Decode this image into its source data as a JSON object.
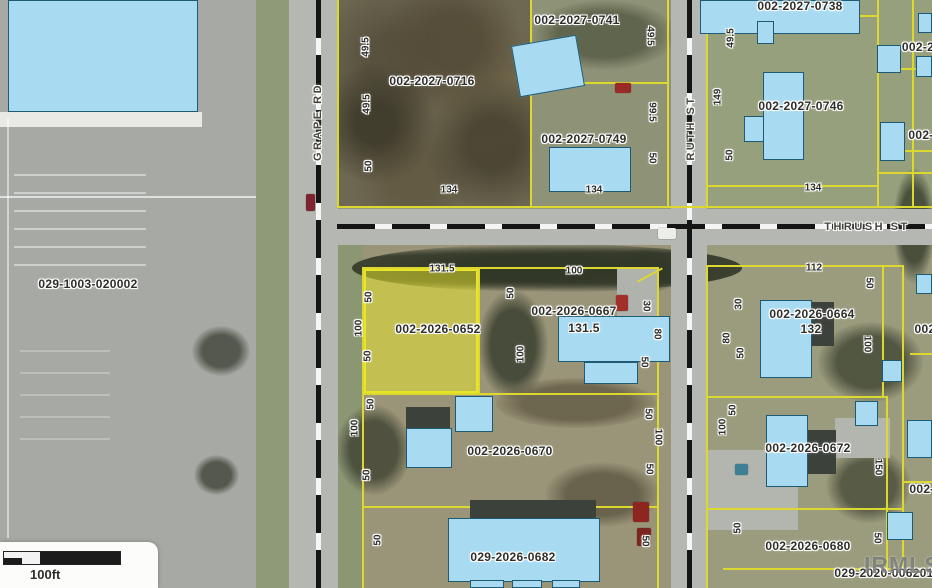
{
  "map": {
    "watermark": "IRMLS",
    "scale_bar": {
      "label": "100ft"
    },
    "highlight": {
      "parcel_id": "002-2026-0652",
      "x": 364,
      "y": 269,
      "w": 114,
      "h": 124
    },
    "colors": {
      "parcel_line": "#dcd82f",
      "highlight_fill": "rgba(236,233,42,0.5)",
      "highlight_edge": "#e8e428",
      "building_fill": "#a8dbf2",
      "building_edge": "#1d5a74",
      "label_text": "#2e2e2a",
      "street_text": "#45453c"
    },
    "streets": [
      {
        "name": "GRAPE RD",
        "x": 318,
        "y": 122,
        "rot": -90
      },
      {
        "name": "THRUSH ST",
        "x": 867,
        "y": 227,
        "rot": 0
      },
      {
        "name": "RUTH ST",
        "x": 691,
        "y": 128,
        "rot": -90
      }
    ],
    "parcel_labels": [
      {
        "text": "002-2027-0741",
        "x": 577,
        "y": 20
      },
      {
        "text": "002-2027-0716",
        "x": 432,
        "y": 81
      },
      {
        "text": "002-2027-0749",
        "x": 584,
        "y": 139
      },
      {
        "text": "002-2027-0738",
        "x": 800,
        "y": 6
      },
      {
        "text": "002-2027-0746",
        "x": 801,
        "y": 106
      },
      {
        "text": "029-1003-020002",
        "x": 88,
        "y": 284
      },
      {
        "text": "002-2026-0652",
        "x": 438,
        "y": 329
      },
      {
        "text": "002-2026-0667",
        "x": 574,
        "y": 311
      },
      {
        "text": "131.5",
        "x": 584,
        "y": 328
      },
      {
        "text": "002-2026-0664",
        "x": 812,
        "y": 314
      },
      {
        "text": "132",
        "x": 811,
        "y": 329
      },
      {
        "text": "002-2026-0670",
        "x": 510,
        "y": 451
      },
      {
        "text": "002-2026-0672",
        "x": 808,
        "y": 448
      },
      {
        "text": "029-2026-0682",
        "x": 513,
        "y": 557
      },
      {
        "text": "002-2026-0680",
        "x": 808,
        "y": 546
      },
      {
        "text": "029-2020-006201",
        "x": 884,
        "y": 573
      },
      {
        "text": "002-2",
        "x": 918,
        "y": 47
      },
      {
        "text": "002-",
        "x": 921,
        "y": 135
      },
      {
        "text": "002",
        "x": 925,
        "y": 329
      },
      {
        "text": "002-",
        "x": 922,
        "y": 489
      }
    ],
    "dimension_labels": [
      {
        "text": "49.5",
        "x": 366,
        "y": 47,
        "rot": -90
      },
      {
        "text": "49.5",
        "x": 367,
        "y": 104,
        "rot": -90
      },
      {
        "text": "50",
        "x": 369,
        "y": 166,
        "rot": -90
      },
      {
        "text": "134",
        "x": 449,
        "y": 190,
        "rot": 0
      },
      {
        "text": "134",
        "x": 594,
        "y": 190,
        "rot": 0
      },
      {
        "text": "49.5",
        "x": 650,
        "y": 36,
        "rot": 90
      },
      {
        "text": "99.5",
        "x": 652,
        "y": 112,
        "rot": 90
      },
      {
        "text": "50",
        "x": 652,
        "y": 158,
        "rot": 90
      },
      {
        "text": "49.5",
        "x": 731,
        "y": 38,
        "rot": -90
      },
      {
        "text": "149",
        "x": 718,
        "y": 97,
        "rot": -90
      },
      {
        "text": "50",
        "x": 730,
        "y": 155,
        "rot": -90
      },
      {
        "text": "134",
        "x": 813,
        "y": 188,
        "rot": 0
      },
      {
        "text": "131.5",
        "x": 442,
        "y": 269,
        "rot": 0
      },
      {
        "text": "100",
        "x": 574,
        "y": 271,
        "rot": 0
      },
      {
        "text": "112",
        "x": 814,
        "y": 268,
        "rot": 0
      },
      {
        "text": "50",
        "x": 369,
        "y": 297,
        "rot": -90
      },
      {
        "text": "100",
        "x": 359,
        "y": 328,
        "rot": -90
      },
      {
        "text": "50",
        "x": 368,
        "y": 356,
        "rot": -90
      },
      {
        "text": "50",
        "x": 511,
        "y": 293,
        "rot": -90
      },
      {
        "text": "100",
        "x": 521,
        "y": 354,
        "rot": -90
      },
      {
        "text": "30",
        "x": 646,
        "y": 306,
        "rot": 90
      },
      {
        "text": "80",
        "x": 657,
        "y": 334,
        "rot": 90
      },
      {
        "text": "50",
        "x": 644,
        "y": 362,
        "rot": 90
      },
      {
        "text": "30",
        "x": 739,
        "y": 304,
        "rot": -90
      },
      {
        "text": "80",
        "x": 727,
        "y": 338,
        "rot": -90
      },
      {
        "text": "50",
        "x": 741,
        "y": 353,
        "rot": -90
      },
      {
        "text": "50",
        "x": 869,
        "y": 283,
        "rot": 90
      },
      {
        "text": "100",
        "x": 867,
        "y": 344,
        "rot": 90
      },
      {
        "text": "50",
        "x": 371,
        "y": 404,
        "rot": -90
      },
      {
        "text": "100",
        "x": 355,
        "y": 428,
        "rot": -90
      },
      {
        "text": "50",
        "x": 367,
        "y": 475,
        "rot": -90
      },
      {
        "text": "50",
        "x": 378,
        "y": 540,
        "rot": -90
      },
      {
        "text": "50",
        "x": 648,
        "y": 414,
        "rot": 90
      },
      {
        "text": "100",
        "x": 658,
        "y": 437,
        "rot": 90
      },
      {
        "text": "50",
        "x": 649,
        "y": 469,
        "rot": 90
      },
      {
        "text": "50",
        "x": 645,
        "y": 541,
        "rot": 90
      },
      {
        "text": "50",
        "x": 733,
        "y": 410,
        "rot": -90
      },
      {
        "text": "100",
        "x": 723,
        "y": 427,
        "rot": -90
      },
      {
        "text": "150",
        "x": 878,
        "y": 467,
        "rot": 90
      },
      {
        "text": "50",
        "x": 877,
        "y": 538,
        "rot": 90
      },
      {
        "text": "50",
        "x": 738,
        "y": 528,
        "rot": -90
      }
    ],
    "parcel_lines": [
      [
        337,
        0,
        2,
        208
      ],
      [
        530,
        0,
        2,
        208
      ],
      [
        667,
        0,
        2,
        208
      ],
      [
        706,
        0,
        2,
        208
      ],
      [
        877,
        0,
        2,
        208
      ],
      [
        912,
        0,
        2,
        208
      ],
      [
        531,
        82,
        138,
        2
      ],
      [
        706,
        15,
        171,
        2
      ],
      [
        877,
        68,
        55,
        2
      ],
      [
        877,
        172,
        55,
        2
      ],
      [
        706,
        185,
        171,
        2
      ],
      [
        337,
        206,
        595,
        2
      ],
      [
        362,
        267,
        2,
        321
      ],
      [
        362,
        267,
        296,
        2
      ],
      [
        478,
        268,
        2,
        127
      ],
      [
        657,
        267,
        2,
        321
      ],
      [
        362,
        393,
        296,
        2
      ],
      [
        362,
        506,
        297,
        2
      ],
      [
        636,
        274,
        28,
        2,
        -28
      ],
      [
        706,
        265,
        198,
        2
      ],
      [
        706,
        267,
        2,
        321
      ],
      [
        882,
        267,
        2,
        130
      ],
      [
        886,
        396,
        2,
        174
      ],
      [
        902,
        265,
        2,
        303
      ],
      [
        706,
        396,
        180,
        2
      ],
      [
        706,
        508,
        198,
        2
      ],
      [
        723,
        568,
        209,
        2
      ],
      [
        903,
        481,
        29,
        2
      ],
      [
        910,
        353,
        22,
        2
      ],
      [
        905,
        150,
        27,
        2
      ]
    ],
    "buildings": [
      {
        "x": 8,
        "y": 0,
        "w": 190,
        "h": 112
      },
      {
        "x": 515,
        "y": 40,
        "w": 66,
        "h": 52,
        "r": -10
      },
      {
        "x": 549,
        "y": 147,
        "w": 82,
        "h": 45
      },
      {
        "x": 700,
        "y": 0,
        "w": 160,
        "h": 34
      },
      {
        "x": 757,
        "y": 21,
        "w": 17,
        "h": 23
      },
      {
        "x": 763,
        "y": 72,
        "w": 41,
        "h": 88
      },
      {
        "x": 744,
        "y": 116,
        "w": 20,
        "h": 26
      },
      {
        "x": 877,
        "y": 45,
        "w": 24,
        "h": 28
      },
      {
        "x": 880,
        "y": 122,
        "w": 25,
        "h": 39
      },
      {
        "x": 916,
        "y": 56,
        "w": 16,
        "h": 21
      },
      {
        "x": 918,
        "y": 13,
        "w": 14,
        "h": 20
      },
      {
        "x": 558,
        "y": 316,
        "w": 112,
        "h": 46
      },
      {
        "x": 584,
        "y": 362,
        "w": 54,
        "h": 22
      },
      {
        "x": 760,
        "y": 300,
        "w": 52,
        "h": 78
      },
      {
        "x": 882,
        "y": 360,
        "w": 20,
        "h": 22
      },
      {
        "x": 916,
        "y": 274,
        "w": 16,
        "h": 20
      },
      {
        "x": 455,
        "y": 396,
        "w": 38,
        "h": 36
      },
      {
        "x": 406,
        "y": 428,
        "w": 46,
        "h": 40
      },
      {
        "x": 448,
        "y": 518,
        "w": 152,
        "h": 64
      },
      {
        "x": 470,
        "y": 580,
        "w": 34,
        "h": 8
      },
      {
        "x": 512,
        "y": 580,
        "w": 30,
        "h": 8
      },
      {
        "x": 552,
        "y": 580,
        "w": 28,
        "h": 8
      },
      {
        "x": 766,
        "y": 415,
        "w": 42,
        "h": 72
      },
      {
        "x": 855,
        "y": 401,
        "w": 23,
        "h": 25
      },
      {
        "x": 907,
        "y": 420,
        "w": 25,
        "h": 38
      },
      {
        "x": 887,
        "y": 512,
        "w": 26,
        "h": 28
      }
    ],
    "roofs": [
      {
        "x": 470,
        "y": 500,
        "w": 126,
        "h": 18
      },
      {
        "x": 806,
        "y": 430,
        "w": 30,
        "h": 44
      },
      {
        "x": 810,
        "y": 302,
        "w": 24,
        "h": 44
      },
      {
        "x": 406,
        "y": 407,
        "w": 44,
        "h": 22
      }
    ],
    "vehicles": [
      {
        "x": 306,
        "y": 194,
        "w": 9,
        "h": 17,
        "c": "#7e2430"
      },
      {
        "x": 616,
        "y": 295,
        "w": 12,
        "h": 16,
        "c": "#a03028"
      },
      {
        "x": 615,
        "y": 83,
        "w": 16,
        "h": 10,
        "c": "#992a24"
      },
      {
        "x": 633,
        "y": 502,
        "w": 16,
        "h": 20,
        "c": "#8e2620"
      },
      {
        "x": 637,
        "y": 528,
        "w": 14,
        "h": 18,
        "c": "#7c241e"
      },
      {
        "x": 735,
        "y": 464,
        "w": 13,
        "h": 11,
        "c": "#3f7f96"
      },
      {
        "x": 658,
        "y": 228,
        "w": 18,
        "h": 11,
        "c": "#eceeea"
      }
    ]
  }
}
